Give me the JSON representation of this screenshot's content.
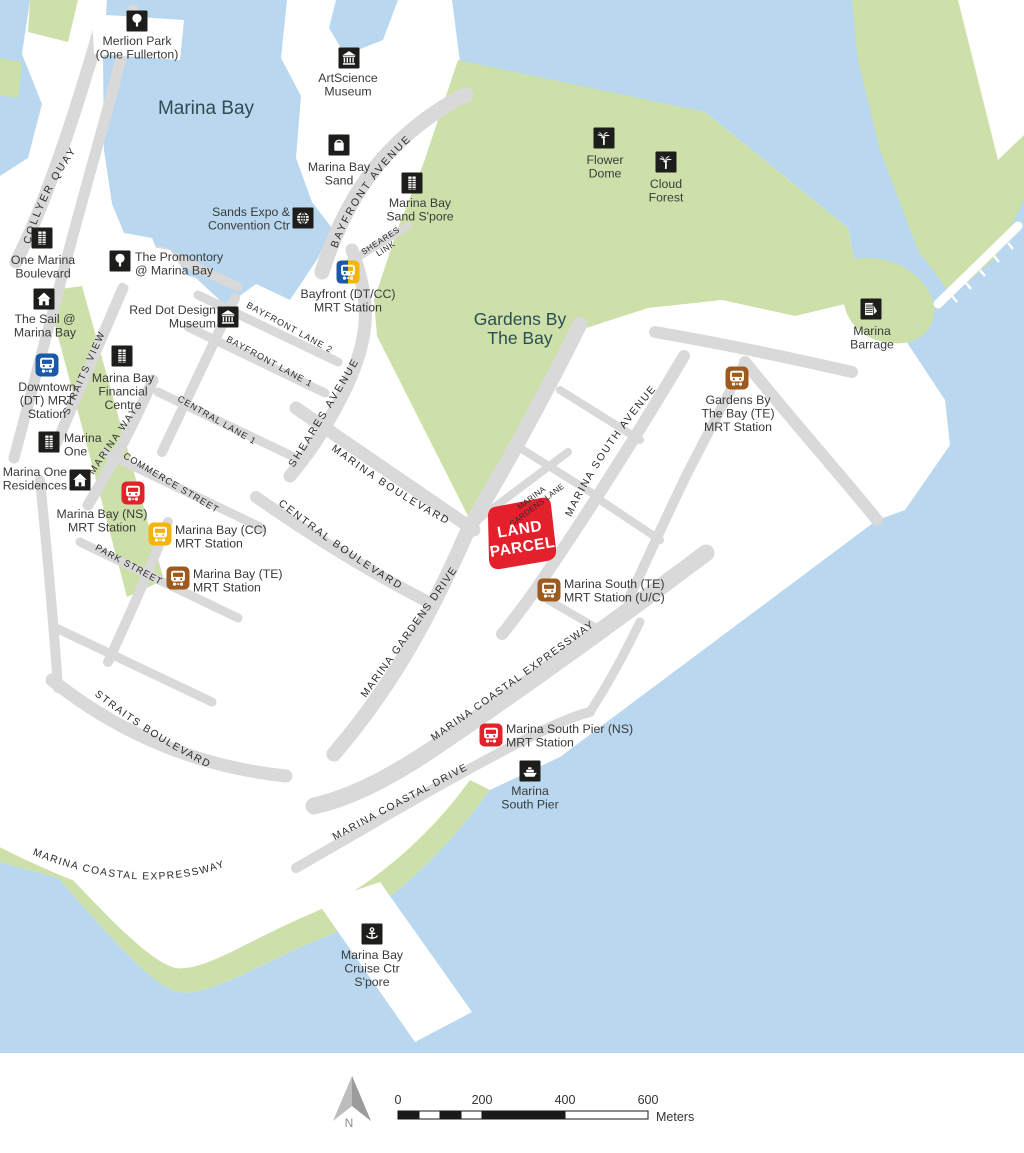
{
  "map": {
    "colors": {
      "water": "#b9d8ef",
      "green": "#cde0aa",
      "road": "#d9d9d9",
      "poi": "#1d1d1b",
      "text": "#3a3a39",
      "road_text": "#2b2b2a",
      "area_text": "#2c4d55",
      "dt": "#1b59a8",
      "cc": "#f4b40c",
      "ns": "#e0222a",
      "te": "#9d5a1e",
      "parcel": "#e5202d"
    },
    "area_labels": [
      {
        "id": "marina-bay-water-label",
        "lines": [
          "Marina Bay"
        ],
        "x": 206,
        "y": 114,
        "size": 19,
        "lh": 20
      },
      {
        "id": "gardens-by-the-bay-label",
        "lines": [
          "Gardens By",
          "The Bay"
        ],
        "x": 520,
        "y": 325,
        "size": 17.5,
        "lh": 19
      }
    ],
    "pois": [
      {
        "id": "merlion-park",
        "icon": "tree",
        "x": 137,
        "y": 21,
        "label": {
          "lines": [
            "Merlion Park",
            "(One Fullerton)"
          ],
          "x": 137,
          "y": 41,
          "align": "center"
        }
      },
      {
        "id": "artscience-museum",
        "icon": "museum",
        "x": 349,
        "y": 58,
        "label": {
          "lines": [
            "ArtScience",
            "Museum"
          ],
          "x": 348,
          "y": 78,
          "align": "center"
        }
      },
      {
        "id": "marina-bay-sand",
        "icon": "bag",
        "x": 339,
        "y": 145,
        "label": {
          "lines": [
            "Marina Bay",
            "Sand"
          ],
          "x": 339,
          "y": 167,
          "align": "center"
        }
      },
      {
        "id": "sands-expo-convention-ctr",
        "icon": "globe",
        "x": 303,
        "y": 218,
        "label": {
          "lines": [
            "Sands Expo &",
            "Convention Ctr"
          ],
          "x": 290,
          "y": 212,
          "align": "right"
        }
      },
      {
        "id": "marina-bay-sand-spore",
        "icon": "building",
        "x": 412,
        "y": 183,
        "label": {
          "lines": [
            "Marina Bay",
            "Sand S'pore"
          ],
          "x": 420,
          "y": 203,
          "align": "center"
        }
      },
      {
        "id": "bayfront-mrt-station",
        "icon": "train",
        "colors": [
          "dt",
          "cc"
        ],
        "x": 348,
        "y": 272,
        "label": {
          "lines": [
            "Bayfront (DT/CC)",
            "MRT Station"
          ],
          "x": 348,
          "y": 294,
          "align": "center"
        }
      },
      {
        "id": "the-promontory",
        "icon": "tree",
        "x": 120,
        "y": 261,
        "label": {
          "lines": [
            "The Promontory",
            "@ Marina Bay"
          ],
          "x": 135,
          "y": 257,
          "align": "left"
        }
      },
      {
        "id": "one-marina-boulevard",
        "icon": "building",
        "x": 42,
        "y": 238,
        "label": {
          "lines": [
            "One Marina",
            "Boulevard"
          ],
          "x": 43,
          "y": 260,
          "align": "center"
        }
      },
      {
        "id": "red-dot-design-museum",
        "icon": "museum",
        "x": 228,
        "y": 317,
        "label": {
          "lines": [
            "Red Dot Design",
            "Museum"
          ],
          "x": 216,
          "y": 310,
          "align": "right"
        }
      },
      {
        "id": "the-sail-marina-bay",
        "icon": "home",
        "x": 44,
        "y": 299,
        "label": {
          "lines": [
            "The Sail @",
            "Marina Bay"
          ],
          "x": 45,
          "y": 319,
          "align": "center"
        }
      },
      {
        "id": "downtown-mrt-station",
        "icon": "train",
        "colors": [
          "dt",
          "dt"
        ],
        "x": 47,
        "y": 365,
        "label": {
          "lines": [
            "Downtown",
            "(DT) MRT",
            "Station"
          ],
          "x": 47,
          "y": 387,
          "align": "center"
        }
      },
      {
        "id": "marina-bay-financial-centre",
        "icon": "building",
        "x": 122,
        "y": 356,
        "label": {
          "lines": [
            "Marina Bay",
            "Financial",
            "Centre"
          ],
          "x": 123,
          "y": 378,
          "align": "center"
        }
      },
      {
        "id": "marina-one",
        "icon": "building",
        "x": 49,
        "y": 442,
        "label": {
          "lines": [
            "Marina",
            "One"
          ],
          "x": 64,
          "y": 438,
          "align": "left"
        }
      },
      {
        "id": "marina-one-residences",
        "icon": "home",
        "x": 80,
        "y": 480,
        "label": {
          "lines": [
            "Marina One",
            "Residences"
          ],
          "x": 67,
          "y": 472,
          "align": "right"
        }
      },
      {
        "id": "marina-bay-ns-mrt-station",
        "icon": "train",
        "colors": [
          "ns",
          "ns"
        ],
        "x": 133,
        "y": 493,
        "label": {
          "lines": [
            "Marina Bay (NS)",
            "MRT Station"
          ],
          "x": 102,
          "y": 514,
          "align": "center"
        }
      },
      {
        "id": "marina-bay-cc-mrt-station",
        "icon": "train",
        "colors": [
          "cc",
          "cc"
        ],
        "x": 160,
        "y": 534,
        "label": {
          "lines": [
            "Marina Bay (CC)",
            "MRT Station"
          ],
          "x": 175,
          "y": 530,
          "align": "left"
        }
      },
      {
        "id": "marina-bay-te-mrt-station",
        "icon": "train",
        "colors": [
          "te",
          "te"
        ],
        "x": 178,
        "y": 578,
        "label": {
          "lines": [
            "Marina Bay (TE)",
            "MRT Station"
          ],
          "x": 193,
          "y": 574,
          "align": "left"
        }
      },
      {
        "id": "gardens-by-the-bay-te-mrt-station",
        "icon": "train",
        "colors": [
          "te",
          "te"
        ],
        "x": 737,
        "y": 378,
        "label": {
          "lines": [
            "Gardens By",
            "The Bay (TE)",
            "MRT Station"
          ],
          "x": 738,
          "y": 400,
          "align": "center"
        }
      },
      {
        "id": "flower-dome",
        "icon": "palm",
        "x": 604,
        "y": 138,
        "label": {
          "lines": [
            "Flower",
            "Dome"
          ],
          "x": 605,
          "y": 160,
          "align": "center"
        }
      },
      {
        "id": "cloud-forest",
        "icon": "palm",
        "x": 666,
        "y": 162,
        "label": {
          "lines": [
            "Cloud",
            "Forest"
          ],
          "x": 666,
          "y": 184,
          "align": "center"
        }
      },
      {
        "id": "marina-barrage",
        "icon": "barrage",
        "x": 871,
        "y": 309,
        "label": {
          "lines": [
            "Marina",
            "Barrage"
          ],
          "x": 872,
          "y": 331,
          "align": "center"
        }
      },
      {
        "id": "marina-south-te-mrt-station",
        "icon": "train",
        "colors": [
          "te",
          "te"
        ],
        "x": 549,
        "y": 590,
        "label": {
          "lines": [
            "Marina South (TE)",
            "MRT Station (U/C)"
          ],
          "x": 564,
          "y": 584,
          "align": "left"
        }
      },
      {
        "id": "marina-south-pier-ns-mrt-station",
        "icon": "train",
        "colors": [
          "ns",
          "ns"
        ],
        "x": 491,
        "y": 735,
        "label": {
          "lines": [
            "Marina South Pier (NS)",
            "MRT Station"
          ],
          "x": 506,
          "y": 729,
          "align": "left"
        }
      },
      {
        "id": "marina-south-pier",
        "icon": "ferry",
        "x": 530,
        "y": 771,
        "label": {
          "lines": [
            "Marina",
            "South Pier"
          ],
          "x": 530,
          "y": 791,
          "align": "center"
        }
      },
      {
        "id": "marina-bay-cruise-ctr",
        "icon": "anchor",
        "x": 372,
        "y": 934,
        "label": {
          "lines": [
            "Marina Bay",
            "Cruise Ctr",
            "S'pore"
          ],
          "x": 372,
          "y": 955,
          "align": "center"
        }
      }
    ],
    "road_labels": [
      {
        "id": "collyer-quay",
        "text": "COLLYER QUAY",
        "path": "p-collyer",
        "size": 10.5,
        "ls": 2.2,
        "off": 16
      },
      {
        "id": "bayfront-avenue",
        "text": "BAYFRONT AVENUE",
        "path": "p-bayfront-ave",
        "size": 10.5,
        "ls": 2.2,
        "off": 10
      },
      {
        "id": "bayfront-lane-2",
        "text": "BAYFRONT LANE 2",
        "path": "p-lane2",
        "size": 9,
        "ls": 1,
        "off": 2
      },
      {
        "id": "bayfront-lane-1",
        "text": "BAYFRONT LANE 1",
        "path": "p-lane1",
        "size": 9,
        "ls": 1,
        "off": 2
      },
      {
        "id": "straits-view",
        "text": "STRAITS VIEW",
        "path": "p-straits-view",
        "size": 9.8,
        "ls": 1.8,
        "off": 16
      },
      {
        "id": "marina-way",
        "text": "MARINA WAY",
        "path": "p-marina-way",
        "size": 9.8,
        "ls": 1.8,
        "off": 6
      },
      {
        "id": "central-lane-1",
        "text": "CENTRAL LANE 1",
        "path": "p-central-lane1",
        "size": 9,
        "ls": 1,
        "off": 1
      },
      {
        "id": "commerce-street",
        "text": "COMMERCE STREET",
        "path": "p-commerce",
        "size": 9.3,
        "ls": 1,
        "off": 3
      },
      {
        "id": "park-street",
        "text": "PARK STREET",
        "path": "p-park",
        "size": 9.3,
        "ls": 1,
        "off": 3
      },
      {
        "id": "sheares-avenue",
        "text": "SHEARES AVENUE",
        "path": "p-sheares-ave",
        "size": 10.5,
        "ls": 2.2,
        "off": 14
      },
      {
        "id": "marina-boulevard",
        "text": "MARINA BOULEVARD",
        "path": "p-marina-blvd",
        "size": 10.5,
        "ls": 2,
        "off": 6
      },
      {
        "id": "central-boulevard",
        "text": "CENTRAL BOULEVARD",
        "path": "p-central-blvd",
        "size": 10.5,
        "ls": 2,
        "off": 10
      },
      {
        "id": "marina-gardens-drive",
        "text": "MARINA GARDENS DRIVE",
        "path": "p-mgd",
        "size": 10.5,
        "ls": 1.4,
        "off": 10
      },
      {
        "id": "marina-south-avenue",
        "text": "MARINA SOUTH AVENUE",
        "path": "p-msa",
        "size": 10.5,
        "ls": 1.6,
        "off": 12
      },
      {
        "id": "marina-coastal-expressway-upper",
        "text": "MARINA COASTAL EXPRESSWAY",
        "path": "p-mce-upper",
        "size": 10.3,
        "ls": 1.4,
        "off": 12
      },
      {
        "id": "marina-coastal-drive",
        "text": "MARINA COASTAL DRIVE",
        "path": "p-mcd",
        "size": 10.3,
        "ls": 1.4,
        "off": 8
      },
      {
        "id": "straits-boulevard",
        "text": "STRAITS BOULEVARD",
        "path": "p-straits-blvd",
        "size": 10.3,
        "ls": 1.6,
        "off": 8
      },
      {
        "id": "marina-coastal-expressway-lower",
        "text": "MARINA COASTAL EXPRESSWAY",
        "path": "p-mce-lower",
        "size": 10.3,
        "ls": 1.4,
        "off": 22
      }
    ],
    "rotated_labels": [
      {
        "id": "sheares-link",
        "lines": [
          "SHEARES",
          "LINK"
        ],
        "x": 382,
        "y": 243,
        "rotate": -33,
        "size": 8.3,
        "ls": 0.6,
        "lh": 9.5
      },
      {
        "id": "marina-gardens-lane",
        "lines": [
          "MARINA",
          "GARDENS LANE"
        ],
        "x": 533,
        "y": 500,
        "rotate": -37,
        "size": 8,
        "ls": 0.3,
        "lh": 9
      }
    ],
    "land_parcel": {
      "lines": [
        "LAND",
        "PARCEL"
      ],
      "x": 521,
      "y": 538,
      "rotate": -9,
      "size": 15.5,
      "lh": 18,
      "color": "#e5202d",
      "text_color": "#ffffff"
    },
    "scale_bar": {
      "ticks": [
        "0",
        "200",
        "400",
        "600"
      ],
      "unit": "Meters"
    },
    "north": {
      "label": "N"
    }
  }
}
